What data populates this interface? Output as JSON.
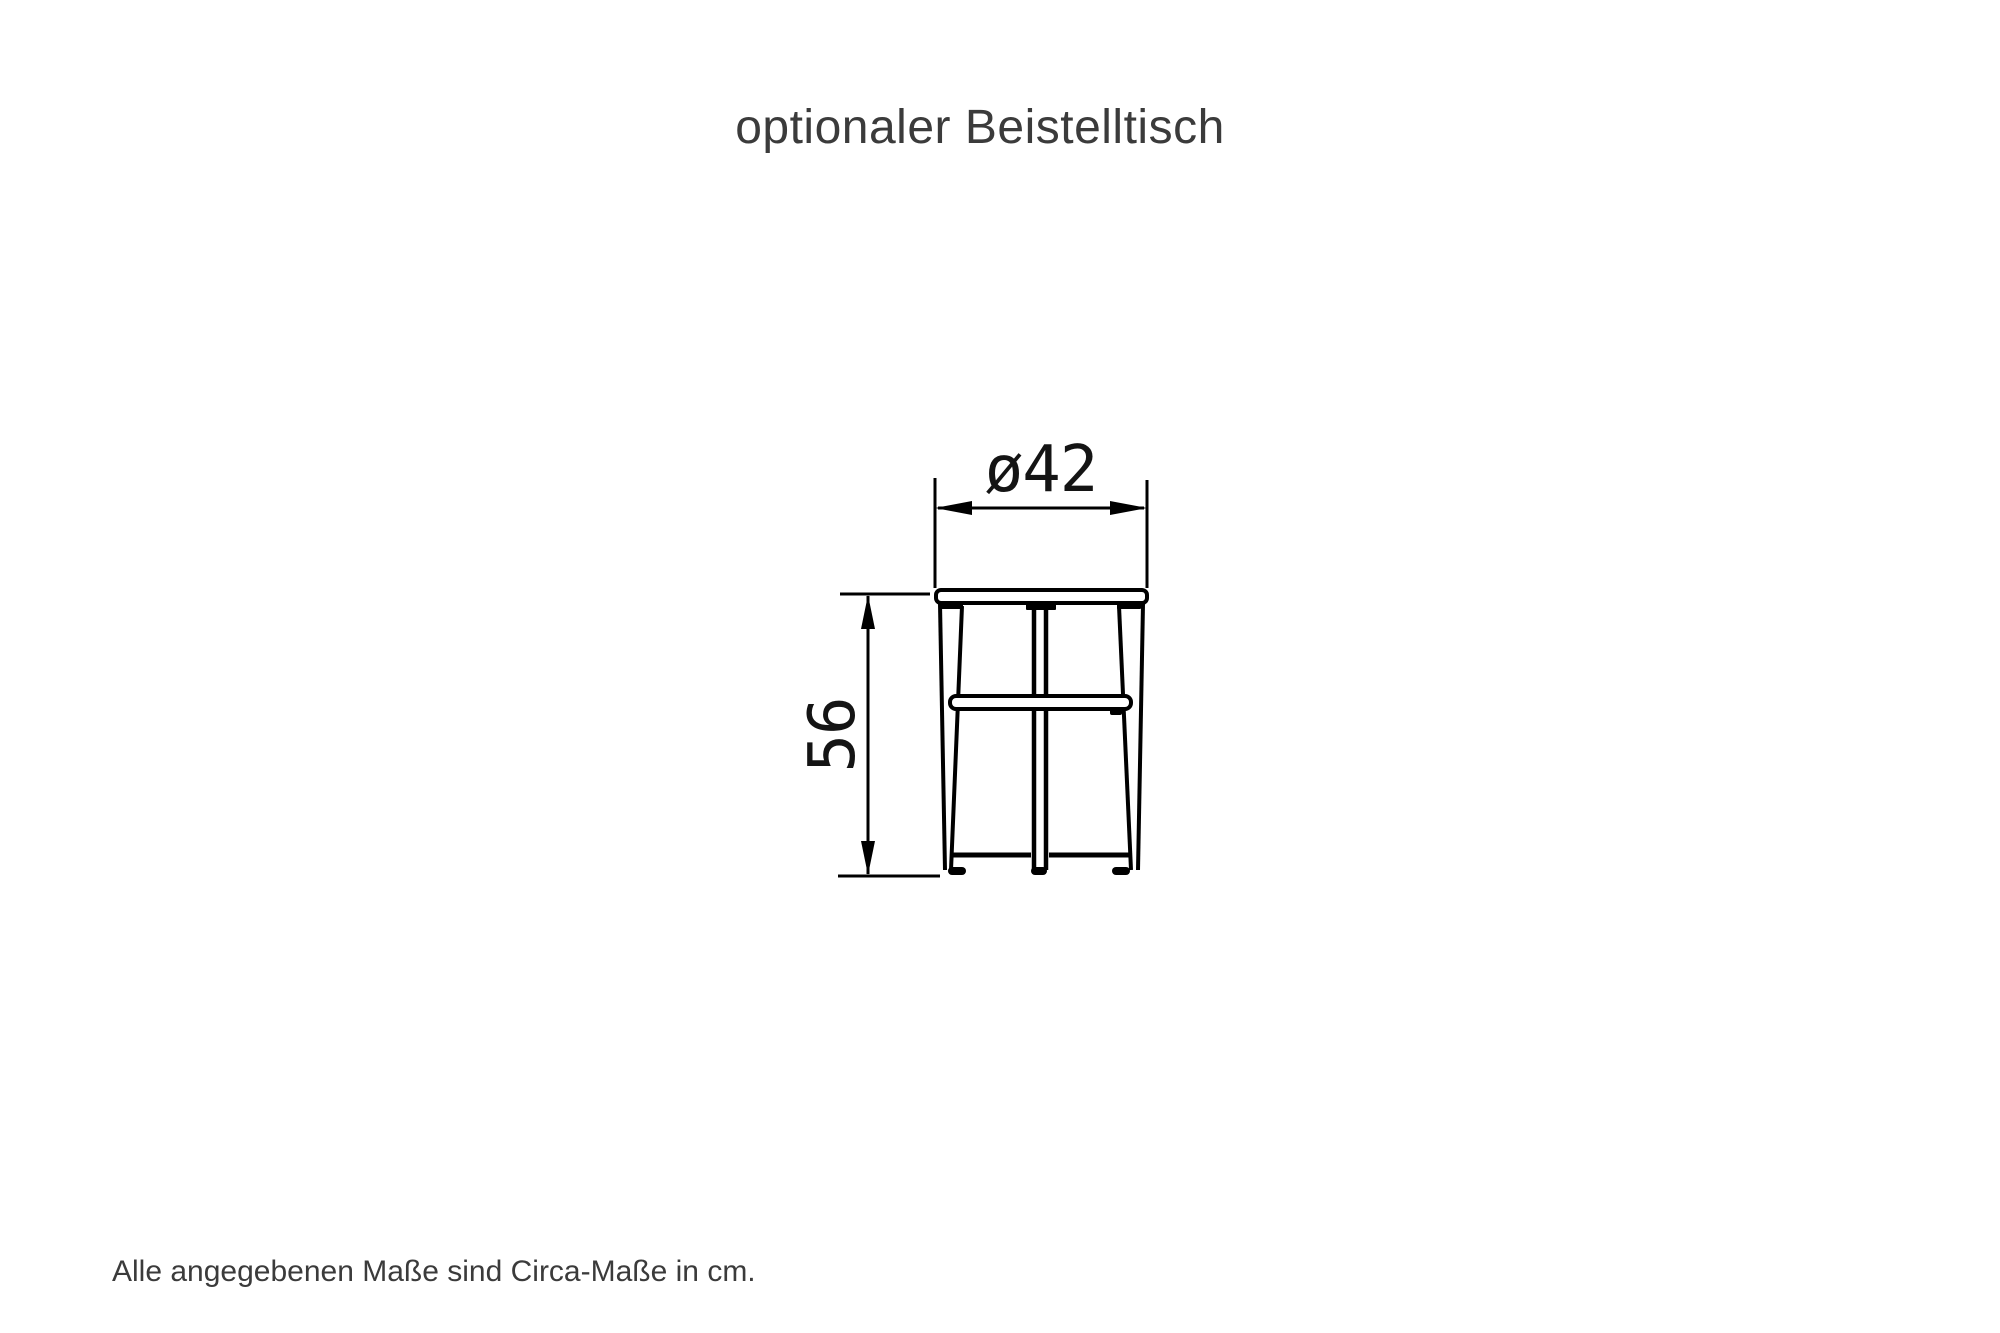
{
  "page": {
    "title": "optionaler Beistelltisch",
    "footer_note": "Alle angegebenen Maße sind Circa-Maße in cm."
  },
  "drawing": {
    "dimensions": {
      "diameter": {
        "label": "ø42",
        "value": 42,
        "unit": "cm",
        "orientation": "horizontal"
      },
      "height": {
        "label": "56",
        "value": 56,
        "unit": "cm",
        "orientation": "vertical"
      }
    },
    "colors": {
      "line": "#000000",
      "dimension_text": "#141414",
      "caption_text": "#3b3b3b",
      "background": "#ffffff"
    }
  }
}
